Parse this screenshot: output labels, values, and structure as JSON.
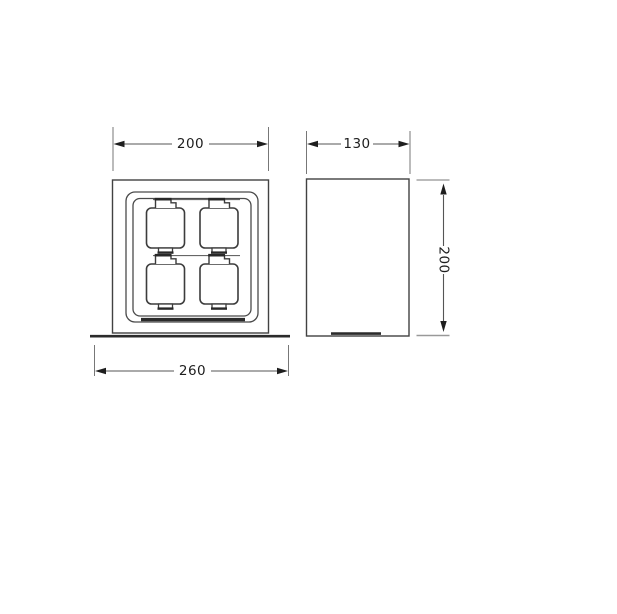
{
  "canvas": {
    "width": 617,
    "height": 614,
    "background": "#ffffff"
  },
  "drawing": {
    "front_view": {
      "top_dimension": "200",
      "bottom_dimension": "260",
      "socket_module_count": 4,
      "socket_icon": "power-socket-module-icon"
    },
    "side_view": {
      "top_dimension": "130",
      "height_dimension": "200"
    },
    "colors": {
      "outline": "#424242",
      "thick_edge": "#2b2b2b",
      "dimension_line": "#555555",
      "extension_line": "#777777",
      "arrow": "#1e1e1e",
      "text": "#1e1e1e",
      "background": "#ffffff"
    }
  }
}
